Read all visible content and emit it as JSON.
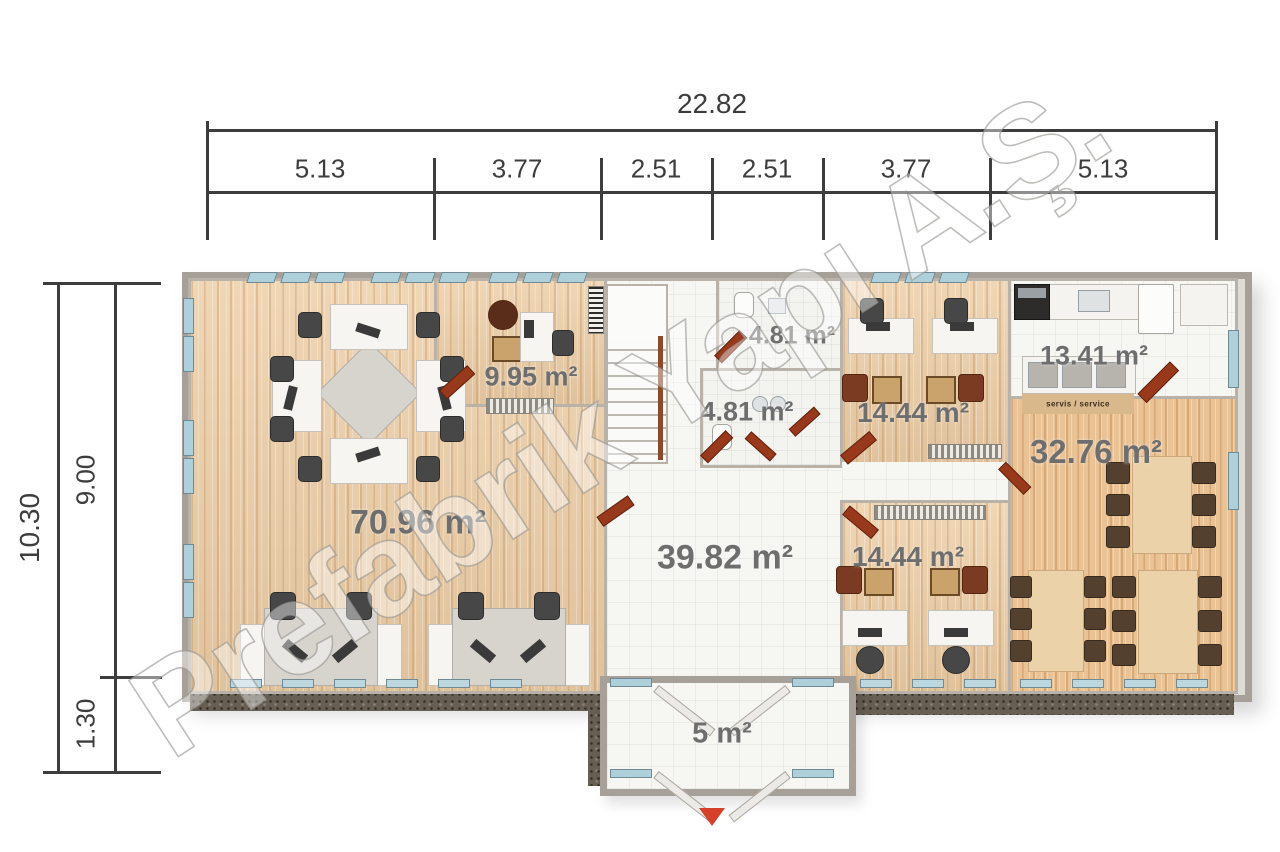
{
  "watermark": {
    "text": "Prefabrik Yapı A.Ş."
  },
  "dimensions": {
    "top": {
      "total": "22.82",
      "segments": [
        "5.13",
        "3.77",
        "2.51",
        "2.51",
        "3.77",
        "5.13"
      ]
    },
    "left": {
      "total": "10.30",
      "segments": [
        "9.00",
        "1.30"
      ]
    }
  },
  "rooms": [
    {
      "name": "open-office",
      "area": "70.96 m²"
    },
    {
      "name": "office",
      "area": "9.95 m²"
    },
    {
      "name": "wc-upper",
      "area": "4.81 m²"
    },
    {
      "name": "wc-lower",
      "area": "4.81 m²"
    },
    {
      "name": "office-upper-right",
      "area": "14.44 m²"
    },
    {
      "name": "office-lower-right",
      "area": "14.44 m²"
    },
    {
      "name": "kitchen",
      "area": "13.41 m²"
    },
    {
      "name": "dining-hall",
      "area": "32.76 m²"
    },
    {
      "name": "hall",
      "area": "39.82 m²"
    },
    {
      "name": "entrance-vestibule",
      "area": "5 m²"
    }
  ],
  "annotations": {
    "service_counter": "servis / service"
  },
  "colors": {
    "entrance_arrow": "#d6402a",
    "door": "#98391b",
    "window": "#aed0da",
    "wood_floor": "#eccda5",
    "tile_floor": "#f6f6f3",
    "wall": "#a7a098",
    "dimension_text": "#3d3d3d",
    "area_label": "#6e6e6e",
    "gravel": "#675f53"
  }
}
